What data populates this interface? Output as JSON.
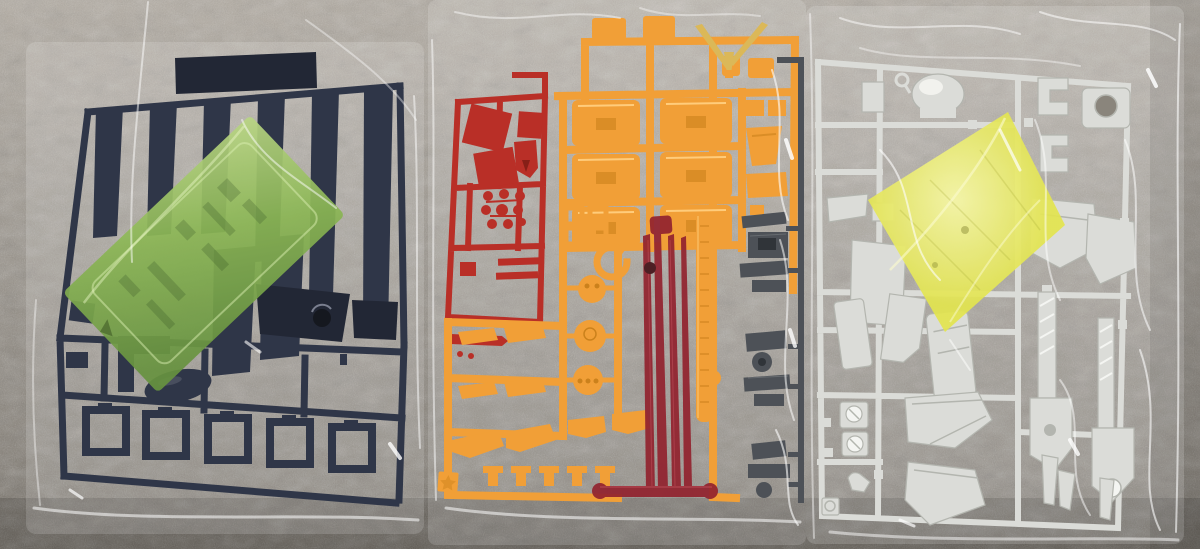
{
  "scene": {
    "background": "grey carpet",
    "items": [
      {
        "name": "left-bag",
        "label": "clear bag with dark navy runner and green clear sticker sheet"
      },
      {
        "name": "middle-bag",
        "label": "clear bag with orange runner, dark red runner, clear red blade parts and dark grey runner"
      },
      {
        "name": "right-bag",
        "label": "clear bag with light grey runner, yellow clear sheet and rifle weapon parts"
      }
    ]
  },
  "colors": {
    "carpet_top": "#b3aca2",
    "carpet_mid": "#99938a",
    "carpet_low": "#827c73",
    "carpet_shadow": "#6e685f",
    "navy": "#232a3d",
    "navy_dark": "#151a29",
    "navy_hi": "#46506e",
    "green_sheet": "#84b24a",
    "green_hi": "#b6d47d",
    "green_deep": "#5e8c34",
    "orange": "#f19a2b",
    "orange_dark": "#c87a0e",
    "orange_hi": "#ffc973",
    "vfin_gold": "#d9b44e",
    "red": "#b5221a",
    "red_dark": "#801109",
    "clear_red": "#8c1522",
    "clear_red_hi": "#c24350",
    "smoke": "#42474d",
    "smoke_dark": "#24282d",
    "grey": "#d9dad5",
    "grey_dark": "#aeb0a9",
    "grey_hi": "#f4f5f1",
    "yellow_sheet": "#e0e243",
    "yellow_hi": "#f6f7a0"
  }
}
